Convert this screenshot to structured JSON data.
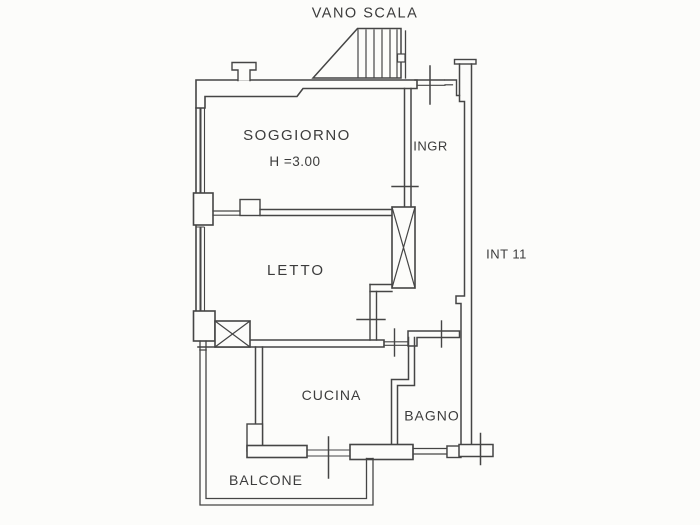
{
  "plan": {
    "header_label": "VANO SCALA",
    "unit_label": "INT 11",
    "rooms": {
      "soggiorno": {
        "label": "SOGGIORNO",
        "height_note": "H =3.00"
      },
      "ingresso": {
        "label": "INGR"
      },
      "letto": {
        "label": "LETTO"
      },
      "cucina": {
        "label": "CUCINA"
      },
      "bagno": {
        "label": "BAGNO"
      },
      "balcone": {
        "label": "BALCONE"
      }
    },
    "colors": {
      "line": "#454545",
      "text": "#3c3c3c",
      "background": "#fcfcfa"
    }
  }
}
